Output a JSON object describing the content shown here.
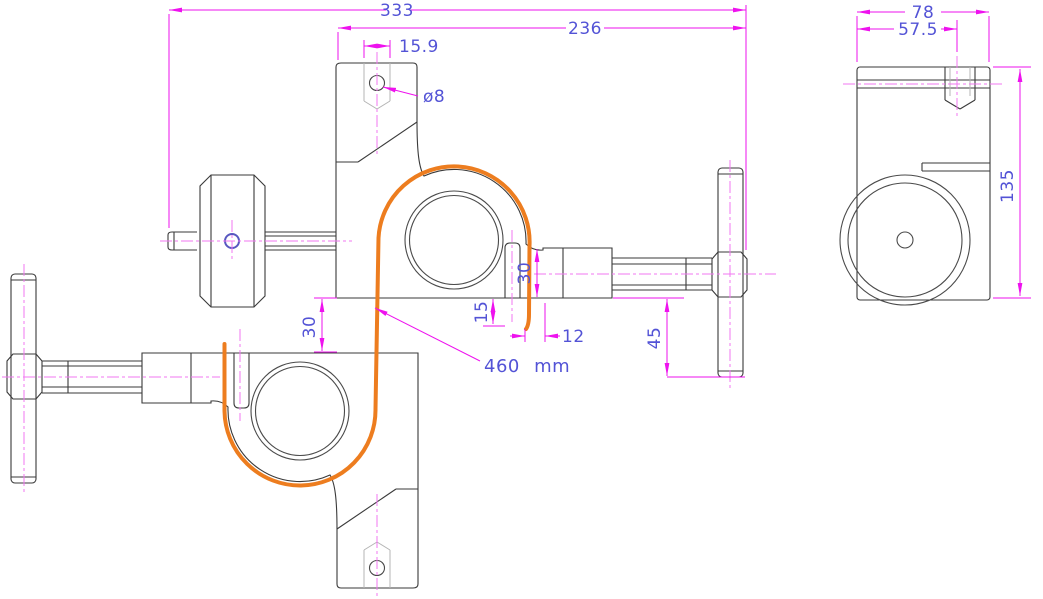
{
  "drawing": {
    "dimensions": {
      "overall_width": "333",
      "upper_width": "236",
      "slot_width": "15.9",
      "hole_diameter": "ø8",
      "block_height": "30",
      "cable_tail_offset": "15",
      "cable_to_block": "12",
      "clamp_gap": "30",
      "handle_drop": "45",
      "cable_length": "460 mm",
      "side_width": "78",
      "side_slot_offset": "57.5",
      "side_height": "135"
    },
    "colors": {
      "outline": "#3a3a3a",
      "detail": "#4a4a4a",
      "faint": "#b4b4b4",
      "dim": "#ee12ee",
      "center": "#f277f2",
      "dimtext": "#5353d6",
      "cable": "#ed7d1f",
      "bg": "#ffffff"
    }
  }
}
